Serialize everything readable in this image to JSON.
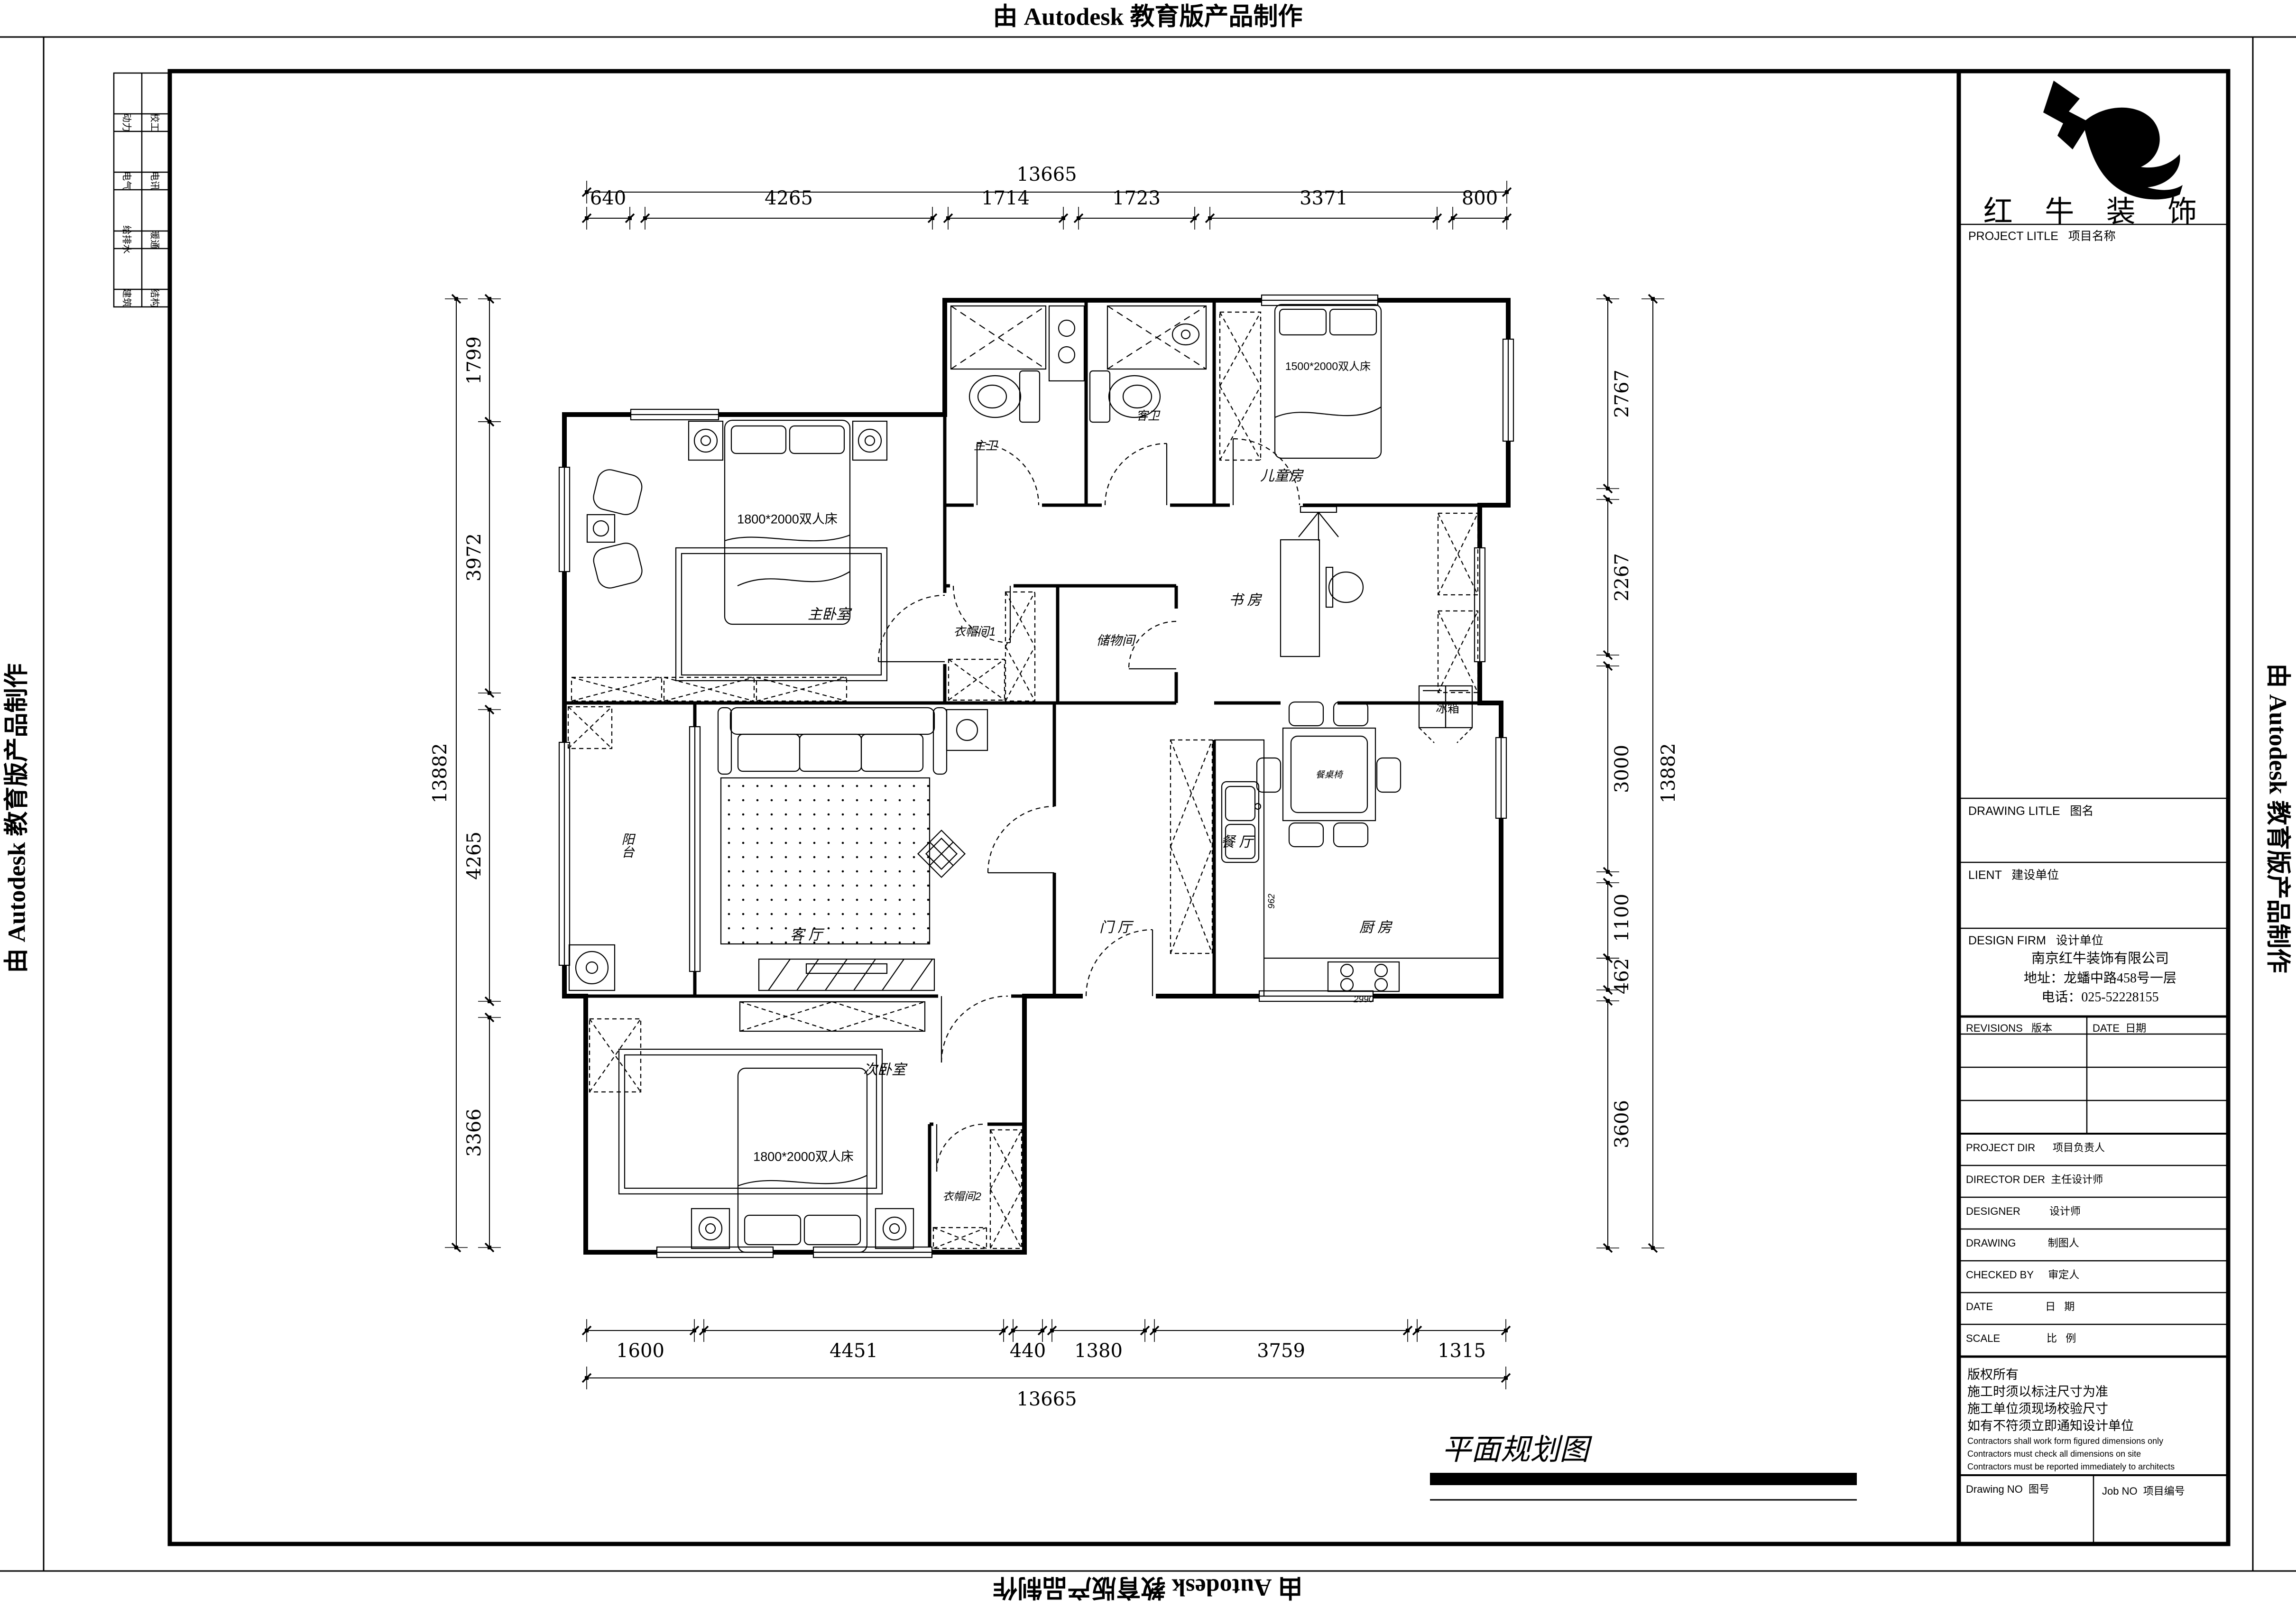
{
  "edge_stamp": "由 Autodesk 教育版产品制作",
  "disciplines": {
    "col1": [
      "动力",
      "电气",
      "给排水",
      "建筑"
    ],
    "col2": [
      "校工",
      "电讯",
      "暖通",
      "结构"
    ]
  },
  "dimensions": {
    "top": {
      "total": "13665",
      "segments": [
        "640",
        "4265",
        "1714",
        "1723",
        "3371",
        "800"
      ]
    },
    "bottom": {
      "total": "13665",
      "segments": [
        "1600",
        "4451",
        "440",
        "1380",
        "3759",
        "1315"
      ]
    },
    "left": {
      "total": "13882",
      "segments": [
        "1799",
        "3972",
        "4265",
        "3366"
      ]
    },
    "right": {
      "total": "13882",
      "segments": [
        "2767",
        "2267",
        "3000",
        "1100",
        "462",
        "3606"
      ]
    }
  },
  "rooms": {
    "master": "主卧室",
    "master_bed": "1800*2000双人床",
    "closet1": "衣帽间1",
    "storage": "储物间",
    "master_bath": "主卫",
    "guest_bath": "客卫",
    "kids": "儿童房",
    "kids_bed": "1500*2000双人床",
    "study": "书 房",
    "dining": "餐 厅",
    "dining_set": "餐桌椅",
    "fridge": "冰箱",
    "kitchen": "厨 房",
    "kitchen_962": "962",
    "kitchen_2990": "2990",
    "foyer": "门 厅",
    "living": "客 厅",
    "balcony": "阳台",
    "bedroom2": "次卧室",
    "bedroom2_bed": "1800*2000双人床",
    "closet2": "衣帽间2"
  },
  "drawing_title": "平面规划图",
  "titleblock": {
    "brand": "红 牛 装 饰",
    "project_title": "PROJECT LITLE   项目名称",
    "drawing_litle": "DRAWING LITLE   图名",
    "client": "LIENT   建设单位",
    "design_firm": "DESIGN FIRM   设计单位",
    "company_name": "南京红牛装饰有限公司",
    "company_addr": "地址：龙蟠中路458号一层",
    "company_tel": "电话：025-52228155",
    "revisions": "REVISIONS   版本",
    "date_col": "DATE  日期",
    "rows": {
      "project_dir": "PROJECT DIR      项目负责人",
      "director": "DIRECTOR DER  主任设计师",
      "designer": "DESIGNER          设计师",
      "drawing": "DRAWING           制图人",
      "checked": "CHECKED BY     审定人",
      "date": "DATE                  日   期",
      "scale": "SCALE                比   例"
    },
    "copyright_cn": [
      "版权所有",
      "施工时须以标注尺寸为准",
      "施工单位须现场校验尺寸",
      "如有不符须立即通知设计单位"
    ],
    "copyright_en": [
      "Contractors shall work form figured dimensions only",
      "Contractors must check all dimensions on site",
      "Contractors must be reported immediately to architects"
    ],
    "drawing_no": "Drawing NO  图号",
    "job_no": "Job NO  项目编号"
  }
}
